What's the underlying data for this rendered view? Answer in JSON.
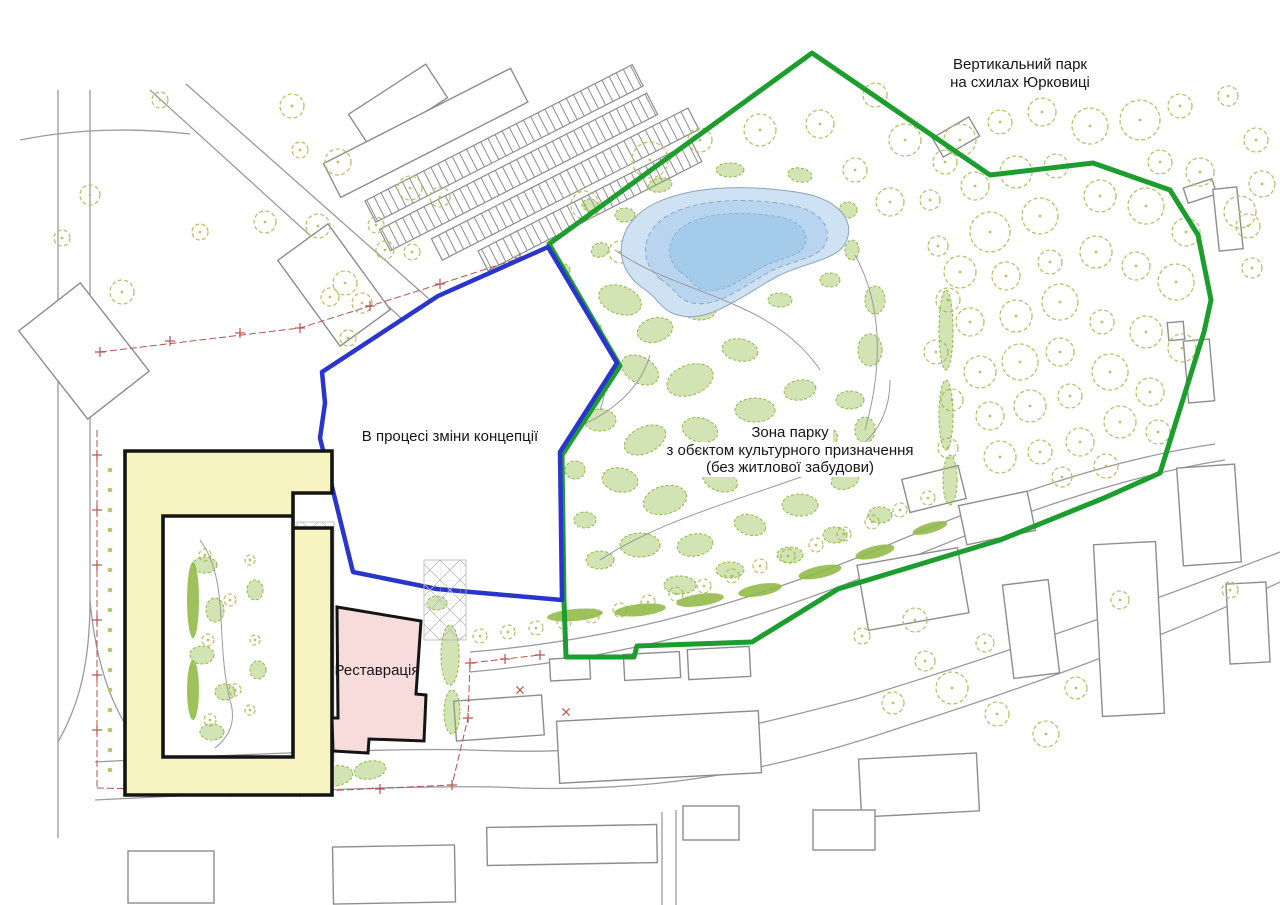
{
  "labels": {
    "vertical_park": {
      "line1": "Вертикальний парк",
      "line2": "на схилах Юрковиці"
    },
    "concept_area": {
      "line1": "В процесі зміни концепції"
    },
    "park_zone": {
      "line1": "Зона парку",
      "line2": "з обєктом культурного призначення",
      "line3": "(без житлової забудови)"
    },
    "restoration": {
      "line1": "Реставрація"
    }
  },
  "colors": {
    "park_boundary_green": "#1b9e2e",
    "concept_boundary_blue": "#2a35cc",
    "residential_building_yellow": "#f7f4c2",
    "restoration_building_pink": "#f8dbdb",
    "pond_blue_outer": "#cfe2f4",
    "pond_blue_mid": "#b9d4ef",
    "pond_blue_inner": "#a5cbea",
    "tree_outline_olive": "#b9c26a",
    "vegetation_green": "#8fb944",
    "cadastral_line_red": "#b2544c",
    "linework_gray": "#8d8d8d"
  }
}
